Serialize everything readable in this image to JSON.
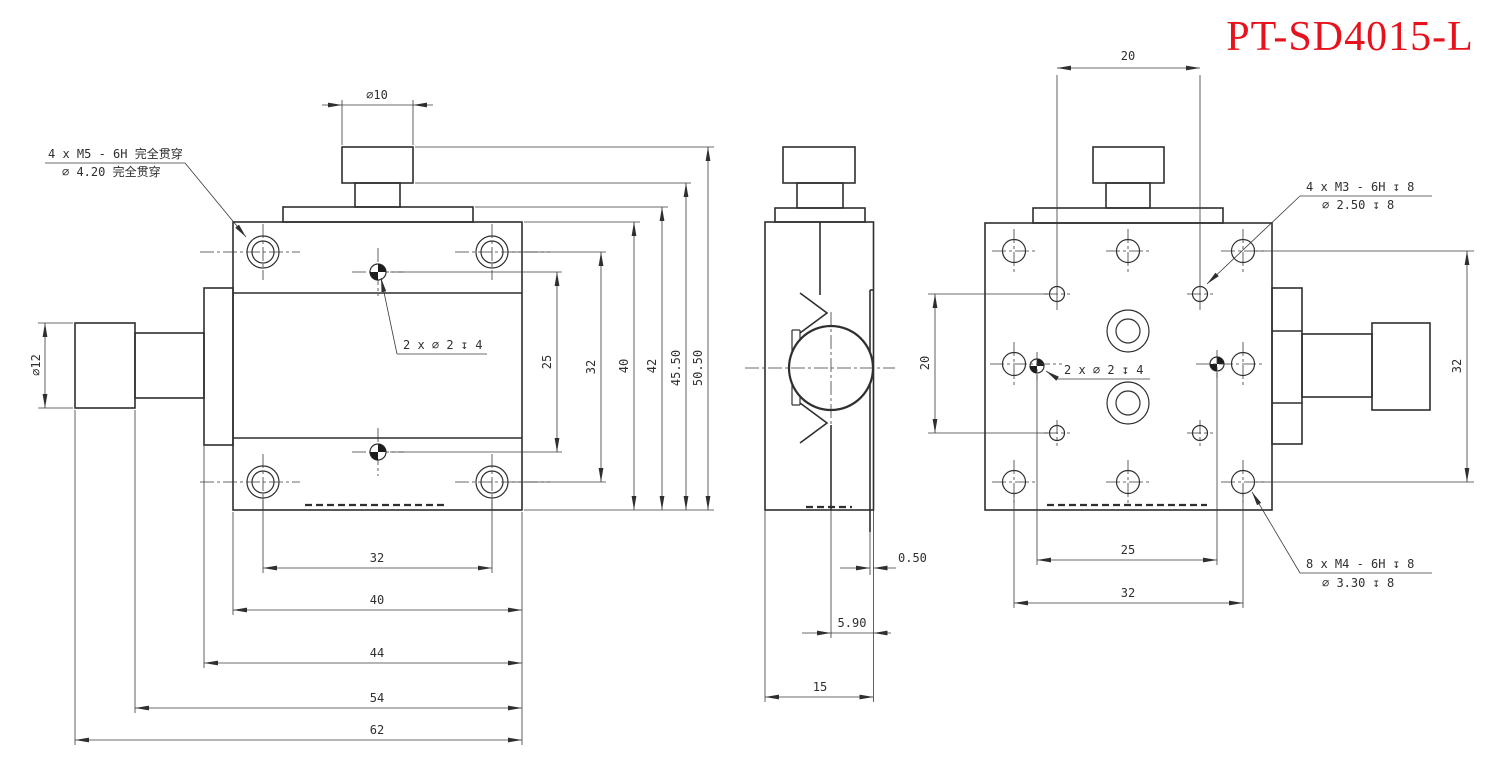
{
  "title": "PT-SD4015-L",
  "title_color": "#e8121c",
  "line_color": "#2f2f2f",
  "callouts": {
    "m5": {
      "line1": "4 x M5 - 6H 完全贯穿",
      "line2": "⌀ 4.20 完全贯穿"
    },
    "m3": {
      "line1": "4 x M3 - 6H ↧ 8",
      "line2": "⌀ 2.50 ↧ 8"
    },
    "m4": {
      "line1": "8 x M4 - 6H ↧ 8",
      "line2": "⌀ 3.30 ↧ 8"
    },
    "pin_front": {
      "label": "2 x ⌀ 2 ↧ 4"
    },
    "pin_back": {
      "label": "2 x ⌀ 2 ↧ 4"
    }
  },
  "front_view": {
    "name": "front-view",
    "dim_top_diameter": "⌀10",
    "dim_left_diameter": "⌀12",
    "dims_right": [
      "25",
      "32",
      "40",
      "42",
      "45.50",
      "50.50"
    ],
    "dims_bottom": [
      "32",
      "40",
      "44",
      "54",
      "62"
    ]
  },
  "side_view": {
    "name": "side-view",
    "dims": [
      "0.50",
      "5.90",
      "15"
    ]
  },
  "back_view": {
    "name": "back-view",
    "dim_top": "20",
    "dim_left": "20",
    "dim_right": "32",
    "dims_bottom": [
      "25",
      "32"
    ]
  }
}
